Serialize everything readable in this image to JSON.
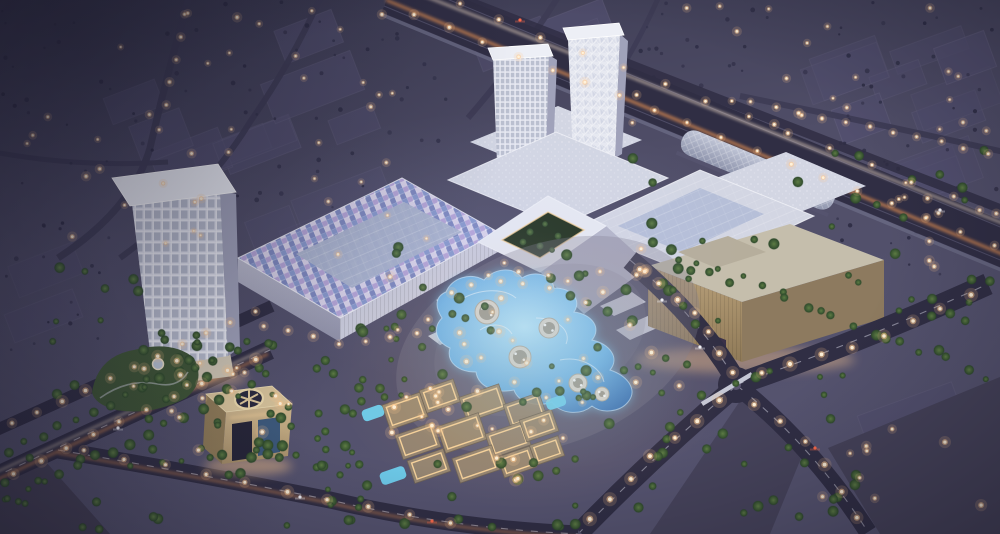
{
  "scene": {
    "title": "Aerial dusk rendering of a shopping mall development: three white towers, mosaic canopy roof, glowing lagoon pool, lit souq village, beige anchor store, gate monument and palm-lined highways",
    "time_of_day": "dusk",
    "view": "aerial"
  },
  "landmarks": [
    {
      "id": "hotel-tower-west",
      "label": "lattice hotel tower"
    },
    {
      "id": "office-tower-grid",
      "label": "grid-facade tower"
    },
    {
      "id": "office-tower-crystal",
      "label": "crystalline-facade tower"
    },
    {
      "id": "mall-canopy-mosaic",
      "label": "mosaic canopy roof"
    },
    {
      "id": "mall-courtyard",
      "label": "colonnade courtyard with trees"
    },
    {
      "id": "anchor-store-beige",
      "label": "beige anchor store"
    },
    {
      "id": "metro-station",
      "label": "elevated metro station tube"
    },
    {
      "id": "lagoon-pool",
      "label": "glowing lagoon pool with round decks"
    },
    {
      "id": "souq-village",
      "label": "lit souq village cluster"
    },
    {
      "id": "gate-monument",
      "label": "square gate monument with ring cutout"
    },
    {
      "id": "highway",
      "label": "highway with light trails"
    }
  ],
  "palette": {
    "sky_top": "#3a3950",
    "sky_mid": "#504e68",
    "ground": "#565470",
    "block": "#535070",
    "block_edge": "#6b6886",
    "road": "#302e44",
    "lane": "#cdcddd",
    "trail_warm": "#ff9f55",
    "trail_white": "#ffe9d0",
    "roof": "#d3d6e3",
    "roof_bright": "#e7e9f1",
    "roof_glass": "#b3bcd6",
    "roof_edge": "#f0f1f7",
    "canopy_a": "#b4a4d6",
    "canopy_b": "#8798cc",
    "canopy_c": "#d8d2e8",
    "canopy_d": "#7d88bf",
    "canopy_panel": "#a9b2cc",
    "wall": "#b9bacc",
    "wall_dark": "#8f90a8",
    "tower_face": "#e1e3ee",
    "tower_side": "#a0a2ba",
    "tower_roof": "#edeff6",
    "tower_win": "#8d95ab",
    "beige_roof": "#c5beac",
    "beige_front_hi": "#b89f78",
    "beige_front_lo": "#8f7a58",
    "beige_side": "#8d7a5f",
    "metro_a": "#c2c7d8",
    "metro_b": "#8e94ac",
    "pool_hi": "#b9e6fb",
    "pool_mid": "#6fb2e4",
    "pool_lo": "#3f74b4",
    "pool_glow": "#7fd4ff",
    "deck": "#d9d4cb",
    "deck_dark": "#6f6a5c",
    "palm_hi": "#5d7c44",
    "palm_lo": "#2f4a2c",
    "tree_bg": "#2e2d45",
    "light": "#ffc98e",
    "light_core": "#fff3dc",
    "village_wall": "#9d8c72",
    "village_edge": "#6e6253",
    "village_glow": "#ffd9a0",
    "arch_top": "#d6c29a",
    "arch_front_hi": "#cdb68e",
    "arch_front_lo": "#a8906a",
    "arch_dark": "#2a293e",
    "arch_glass": "#3c587a",
    "garden": "#3f5636",
    "plaza": "#817c90",
    "dune": "#454157",
    "district": "#46435a",
    "car_white": "#f2f2f8",
    "car_red": "#ff6a4a"
  },
  "procedural": {
    "seed": 11,
    "blocks": [
      {
        "x": 0,
        "y": 0,
        "w": 440,
        "h": 250,
        "count": 12,
        "rot": -21
      },
      {
        "x": 470,
        "y": 0,
        "w": 180,
        "h": 70,
        "count": 3,
        "rot": -21
      },
      {
        "x": 650,
        "y": 0,
        "w": 350,
        "h": 150,
        "count": 8,
        "rot": -20
      },
      {
        "x": 820,
        "y": 150,
        "w": 180,
        "h": 120,
        "count": 4,
        "rot": -20
      },
      {
        "x": 860,
        "y": 380,
        "w": 140,
        "h": 150,
        "count": 4,
        "rot": -20
      },
      {
        "x": 0,
        "y": 250,
        "w": 90,
        "h": 100,
        "count": 2,
        "rot": -21
      }
    ],
    "bg_trees": [
      {
        "x": 0,
        "y": 0,
        "w": 450,
        "h": 255,
        "count": 80
      },
      {
        "x": 620,
        "y": 0,
        "w": 380,
        "h": 150,
        "count": 55
      },
      {
        "x": 830,
        "y": 150,
        "w": 170,
        "h": 130,
        "count": 20
      },
      {
        "x": 0,
        "y": 250,
        "w": 100,
        "h": 110,
        "count": 12
      }
    ],
    "palm_areas": [
      {
        "x": 145,
        "y": 325,
        "w": 255,
        "h": 150,
        "count": 65
      },
      {
        "x": 395,
        "y": 245,
        "w": 300,
        "h": 170,
        "count": 40
      },
      {
        "x": 560,
        "y": 370,
        "w": 310,
        "h": 150,
        "count": 38
      },
      {
        "x": 630,
        "y": 150,
        "w": 360,
        "h": 180,
        "count": 30
      },
      {
        "x": 45,
        "y": 265,
        "w": 125,
        "h": 130,
        "count": 14
      },
      {
        "x": 280,
        "y": 455,
        "w": 300,
        "h": 75,
        "count": 26
      },
      {
        "x": 880,
        "y": 250,
        "w": 120,
        "h": 130,
        "count": 10
      },
      {
        "x": 0,
        "y": 430,
        "w": 180,
        "h": 100,
        "count": 14
      }
    ],
    "palm_lines": [
      {
        "pts": [
          [
            0,
            455
          ],
          [
            255,
            338
          ]
        ],
        "count": 15
      },
      {
        "pts": [
          [
            0,
            502
          ],
          [
            262,
            382
          ]
        ],
        "count": 15
      },
      {
        "pts": [
          [
            640,
            238
          ],
          [
            1000,
            382
          ]
        ],
        "count": 16
      }
    ],
    "light_regions": [
      {
        "x": 0,
        "y": 0,
        "w": 430,
        "h": 250,
        "count": 40,
        "r": 1.6
      },
      {
        "x": 620,
        "y": 0,
        "w": 380,
        "h": 140,
        "count": 22,
        "r": 1.6
      },
      {
        "x": 830,
        "y": 150,
        "w": 170,
        "h": 120,
        "count": 10,
        "r": 1.7
      },
      {
        "x": 430,
        "y": 262,
        "w": 250,
        "h": 150,
        "count": 26,
        "r": 2.1
      },
      {
        "x": 372,
        "y": 385,
        "w": 195,
        "h": 100,
        "count": 20,
        "r": 2.1
      },
      {
        "x": 335,
        "y": 240,
        "w": 310,
        "h": 95,
        "count": 16,
        "r": 1.9
      },
      {
        "x": 95,
        "y": 335,
        "w": 215,
        "h": 130,
        "count": 12,
        "r": 2.0
      },
      {
        "x": 795,
        "y": 420,
        "w": 205,
        "h": 105,
        "count": 9,
        "r": 1.9
      },
      {
        "x": 148,
        "y": 355,
        "w": 95,
        "h": 55,
        "count": 6,
        "r": 2.0
      }
    ],
    "light_lines": [
      {
        "pts": [
          [
            398,
            8
          ],
          [
            1012,
            252
          ]
        ],
        "count": 18,
        "r": 2.0
      },
      {
        "pts": [
          [
            438,
            -4
          ],
          [
            1016,
            222
          ]
        ],
        "count": 14,
        "r": 1.8
      },
      {
        "pts": [
          [
            632,
            262
          ],
          [
            700,
            318
          ],
          [
            737,
            383
          ]
        ],
        "count": 7,
        "r": 2.6
      },
      {
        "pts": [
          [
            745,
            378
          ],
          [
            860,
            345
          ],
          [
            985,
            288
          ]
        ],
        "count": 8,
        "r": 2.6
      },
      {
        "pts": [
          [
            730,
            392
          ],
          [
            650,
            458
          ],
          [
            580,
            530
          ]
        ],
        "count": 7,
        "r": 2.6
      },
      {
        "pts": [
          [
            742,
            394
          ],
          [
            812,
            446
          ],
          [
            866,
            530
          ]
        ],
        "count": 6,
        "r": 2.4
      },
      {
        "pts": [
          [
            0,
            428
          ],
          [
            268,
            306
          ]
        ],
        "count": 11,
        "r": 2.2
      },
      {
        "pts": [
          [
            0,
            482
          ],
          [
            130,
            416
          ],
          [
            268,
            352
          ]
        ],
        "count": 10,
        "r": 2.4
      },
      {
        "pts": [
          [
            62,
            448
          ],
          [
            200,
            472
          ],
          [
            330,
            500
          ],
          [
            470,
            528
          ]
        ],
        "count": 10,
        "r": 2.4
      },
      {
        "pts": [
          [
            188,
            2
          ],
          [
            158,
            140
          ]
        ],
        "count": 6,
        "r": 1.7
      },
      {
        "pts": [
          [
            740,
            100
          ],
          [
            1000,
            155
          ]
        ],
        "count": 11,
        "r": 1.8
      },
      {
        "pts": [
          [
            250,
            322
          ],
          [
            340,
            344
          ],
          [
            430,
            330
          ]
        ],
        "count": 7,
        "r": 2.0
      }
    ],
    "village": {
      "rot": -19,
      "boxes": [
        [
          385,
          398,
          40,
          26
        ],
        [
          422,
          384,
          36,
          24
        ],
        [
          462,
          390,
          42,
          26
        ],
        [
          506,
          398,
          38,
          25
        ],
        [
          398,
          428,
          40,
          26
        ],
        [
          440,
          419,
          44,
          28
        ],
        [
          488,
          427,
          40,
          25
        ],
        [
          522,
          414,
          34,
          23
        ],
        [
          410,
          454,
          38,
          24
        ],
        [
          455,
          451,
          42,
          26
        ],
        [
          500,
          451,
          34,
          22
        ],
        [
          532,
          440,
          30,
          21
        ]
      ],
      "pools": [
        [
          362,
          407,
          22,
          12
        ],
        [
          380,
          469,
          26,
          13
        ],
        [
          546,
          397,
          20,
          11
        ]
      ]
    },
    "courtyard_trees": [
      [
        530,
        232
      ],
      [
        545,
        224
      ],
      [
        558,
        236
      ],
      [
        540,
        246
      ],
      [
        552,
        250
      ],
      [
        523,
        242
      ]
    ],
    "cars": [
      [
        300,
        497,
        "car_white"
      ],
      [
        432,
        521,
        "car_red"
      ],
      [
        700,
        347,
        "car_white"
      ],
      [
        815,
        448,
        "car_red"
      ],
      [
        118,
        428,
        "car_white"
      ],
      [
        662,
        300,
        "car_white"
      ],
      [
        940,
        210,
        "car_white"
      ],
      [
        520,
        20,
        "car_red"
      ]
    ]
  }
}
